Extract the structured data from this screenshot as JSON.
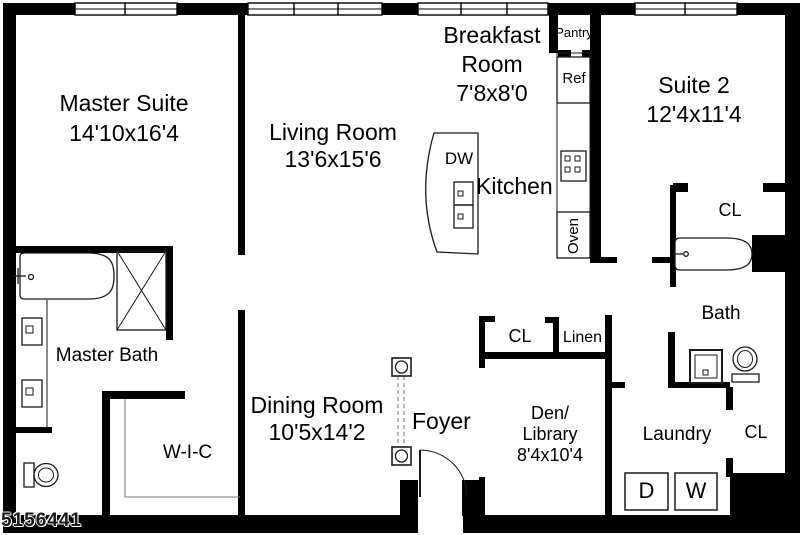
{
  "title": "Apartment floor plan",
  "watermark": "5156441",
  "rooms": {
    "master_suite": {
      "lines": [
        "Master Suite",
        "14'10x16'4"
      ]
    },
    "living_room": {
      "lines": [
        "Living Room",
        "13'6x15'6"
      ]
    },
    "breakfast_room": {
      "lines": [
        "Breakfast",
        "Room",
        "7'8x8'0"
      ]
    },
    "suite_2": {
      "lines": [
        "Suite 2",
        "12'4x11'4"
      ]
    },
    "kitchen": {
      "label": "Kitchen"
    },
    "dining_room": {
      "lines": [
        "Dining Room",
        "10'5x14'2"
      ]
    },
    "foyer": {
      "label": "Foyer"
    },
    "den_library": {
      "lines": [
        "Den/",
        "Library",
        "8'4x10'4"
      ]
    },
    "master_bath": {
      "label": "Master Bath"
    },
    "walk_in_closet": {
      "label": "W-I-C"
    },
    "bath": {
      "label": "Bath"
    },
    "laundry": {
      "label": "Laundry"
    },
    "pantry": {
      "label": "Pantry"
    }
  },
  "closets": {
    "suite2_closet": "CL",
    "hall_closet": "CL",
    "linen_closet": "Linen",
    "laundry_closet": "CL"
  },
  "appliances": {
    "refrigerator": "Ref",
    "oven": "Oven",
    "dishwasher": "DW",
    "dryer": "D",
    "washer": "W"
  },
  "colors": {
    "wall": "#000000",
    "background": "#ffffff",
    "fixture_line": "#1a1a1a",
    "thin_line": "#777777",
    "railing_dash": "#888888"
  }
}
